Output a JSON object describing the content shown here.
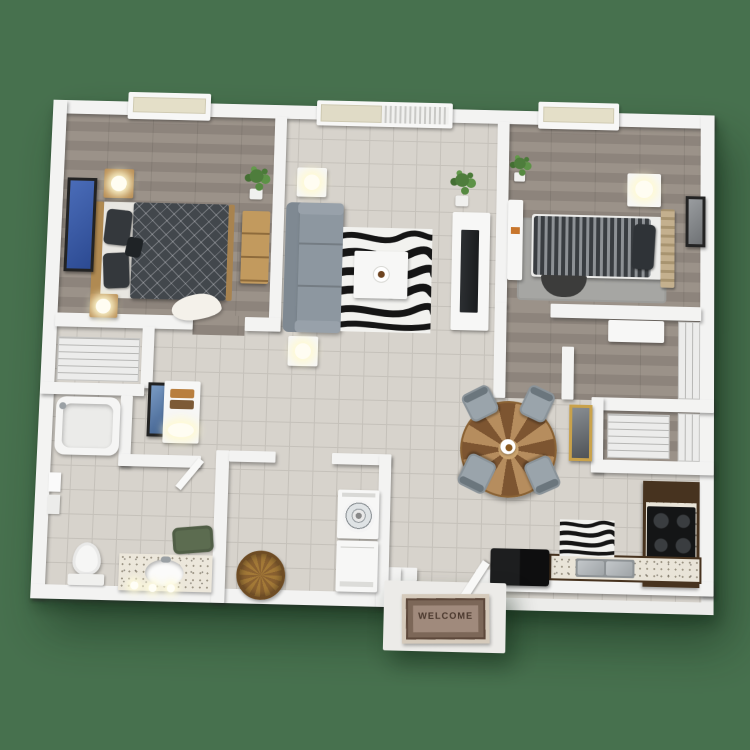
{
  "scene": {
    "type": "3d-floor-plan-render",
    "description": "Top-down 3D rendering of a two-bedroom, one-bathroom apartment floor plan on a solid green background",
    "background": "green"
  },
  "colors": {
    "background": "#47714e",
    "wall": "#f3f3f2",
    "tile": "#d7d3cc",
    "grout": "#c5c1ba",
    "wood": "#9b9289",
    "wood-dark": "#8d847c",
    "sofa": "#8d97a0",
    "sofa-back": "#7f8992",
    "chair": "#9aa4ab",
    "counter": "#e9e4d8",
    "cabinet": "#47331f",
    "appliance": "#161617",
    "bed-dark": "#42474c",
    "plant": "#4e7d3c",
    "mat": "#a08a7c",
    "mat-border": "#5d483b",
    "mat-text": "#4a382d",
    "basket": "#a37937",
    "gold": "#c9a24b",
    "fur": "#f4f1ea",
    "rug-gray": "#a6a6a3"
  },
  "entry": {
    "welcome_mat_text": "WELCOME"
  },
  "rooms": [
    {
      "name": "bedroom-1",
      "floor": "wood",
      "items": [
        "window",
        "queen-bed",
        "wood-headboard",
        "pillows",
        "nightstand-with-lamp-top",
        "nightstand-with-lamp-bottom",
        "blue-wall-art",
        "dresser",
        "potted-plant",
        "fur-rug"
      ]
    },
    {
      "name": "living-room",
      "floor": "tile",
      "items": [
        "sliding-glass-door",
        "vertical-blinds",
        "gray-sofa",
        "side-table-with-lamp-top",
        "side-table-with-lamp-bottom",
        "zebra-rug",
        "white-coffee-table",
        "centerpiece",
        "tv-console",
        "flat-tv",
        "potted-plant"
      ]
    },
    {
      "name": "bedroom-2",
      "floor": "wood",
      "items": [
        "window",
        "twin-bed-striped",
        "slat-headboard",
        "dark-pillow",
        "nightstand-with-lamp",
        "white-desk",
        "gray-area-rug",
        "half-round-rug",
        "wall-art",
        "potted-plant"
      ]
    },
    {
      "name": "walk-in-closet",
      "floor": "wood",
      "items": [
        "wire-shelving",
        "closet-cabinet"
      ]
    },
    {
      "name": "linen-closet",
      "floor": "tile",
      "items": [
        "wire-shelving"
      ]
    },
    {
      "name": "hallway",
      "floor": "tile",
      "items": [
        "wall-art",
        "dresser-with-towels",
        "table-lamp"
      ]
    },
    {
      "name": "bathroom",
      "floor": "tile",
      "items": [
        "bathtub",
        "shower-head",
        "towel-bar",
        "toilet",
        "vanity-with-sink",
        "faucet",
        "vanity-lights",
        "bath-mat",
        "door"
      ]
    },
    {
      "name": "laundry-room",
      "floor": "tile",
      "items": [
        "washer",
        "dryer",
        "wicker-basket"
      ]
    },
    {
      "name": "dining-area",
      "floor": "tile",
      "items": [
        "round-pinwheel-table",
        "dining-chair-nw",
        "dining-chair-ne",
        "dining-chair-sw",
        "dining-chair-se",
        "centerpiece",
        "gold-framed-mirror"
      ]
    },
    {
      "name": "kitchen",
      "floor": "tile",
      "items": [
        "dark-cabinet-counter-right",
        "range-stove",
        "dark-cabinet-counter-bottom",
        "double-sink",
        "refrigerator",
        "zebra-rug-small"
      ]
    },
    {
      "name": "entry",
      "floor": "tile",
      "items": [
        "front-door",
        "stoop",
        "welcome-mat"
      ]
    }
  ]
}
